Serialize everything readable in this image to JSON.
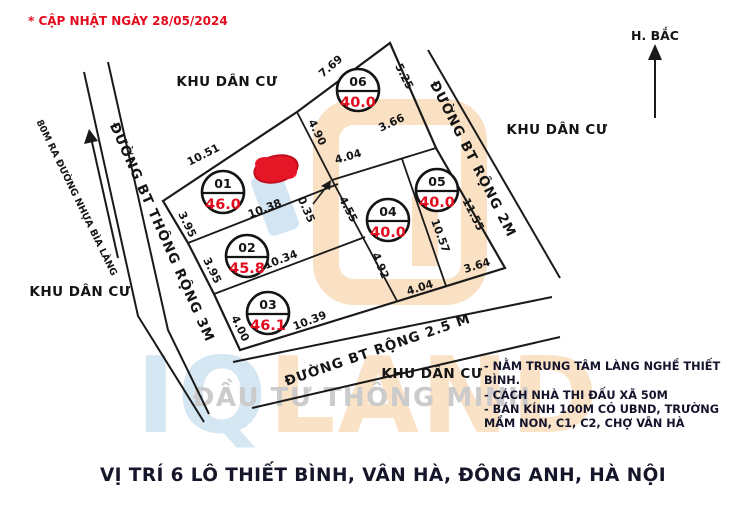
{
  "updated": "* CẬP NHẬT NGÀY  28/05/2024",
  "compass": {
    "label": "H. BẮC"
  },
  "areas": {
    "top": "KHU DÂN CƯ",
    "right": "KHU DÂN CƯ",
    "left": "KHU DÂN CƯ",
    "bottom": "KHU DÂN CƯ"
  },
  "roads": {
    "road_3m": "ĐƯỜNG BT THÔNG RỘNG 3M",
    "road_2m": "ĐƯỜNG BT RỘNG 2M",
    "road_2_5m": "ĐƯỜNG BT RỘNG 2.5 M",
    "access_note": "80M RA ĐƯỜNG NHỰA BÌA LÀNG"
  },
  "plots": [
    {
      "no": "01",
      "area": "46.0"
    },
    {
      "no": "02",
      "area": "45.8"
    },
    {
      "no": "03",
      "area": "46.1"
    },
    {
      "no": "04",
      "area": "40.0"
    },
    {
      "no": "05",
      "area": "40.0"
    },
    {
      "no": "06",
      "area": "40.0"
    }
  ],
  "dims": [
    "10.51",
    "7.69",
    "5.25",
    "4.90",
    "3.66",
    "4.04",
    "0.35",
    "4.55",
    "10.38",
    "3.95",
    "3.95",
    "10.34",
    "4.92",
    "4.04",
    "3.64",
    "11.55",
    "10.57",
    "4.00",
    "10.39"
  ],
  "notes": {
    "line1": "- NẰM TRUNG TÂM LÀNG NGHỀ THIẾT",
    "line2": "BÌNH.",
    "line3": "- CÁCH NHÀ THI ĐẤU XÃ 50M",
    "line4": "- BÁN KÍNH 100M CÓ UBND, TRƯỜNG",
    "line5": "MẦM NON, C1, C2, CHỢ VÂN HÀ"
  },
  "title": "VỊ TRÍ 6 LÔ THIẾT BÌNH, VÂN HÀ, ĐÔNG ANH, HÀ NỘI",
  "watermark": {
    "brand_iq": "IQ",
    "brand_land": "LAND",
    "tagline": "ĐẦU TƯ THÔNG MINH"
  },
  "colors": {
    "red": "#e30b1e",
    "line_black": "#1a1a1a",
    "wm_blue": "#c0daee",
    "wm_orange": "#f8d3a8",
    "wm_grey": "#c6c6c6"
  }
}
